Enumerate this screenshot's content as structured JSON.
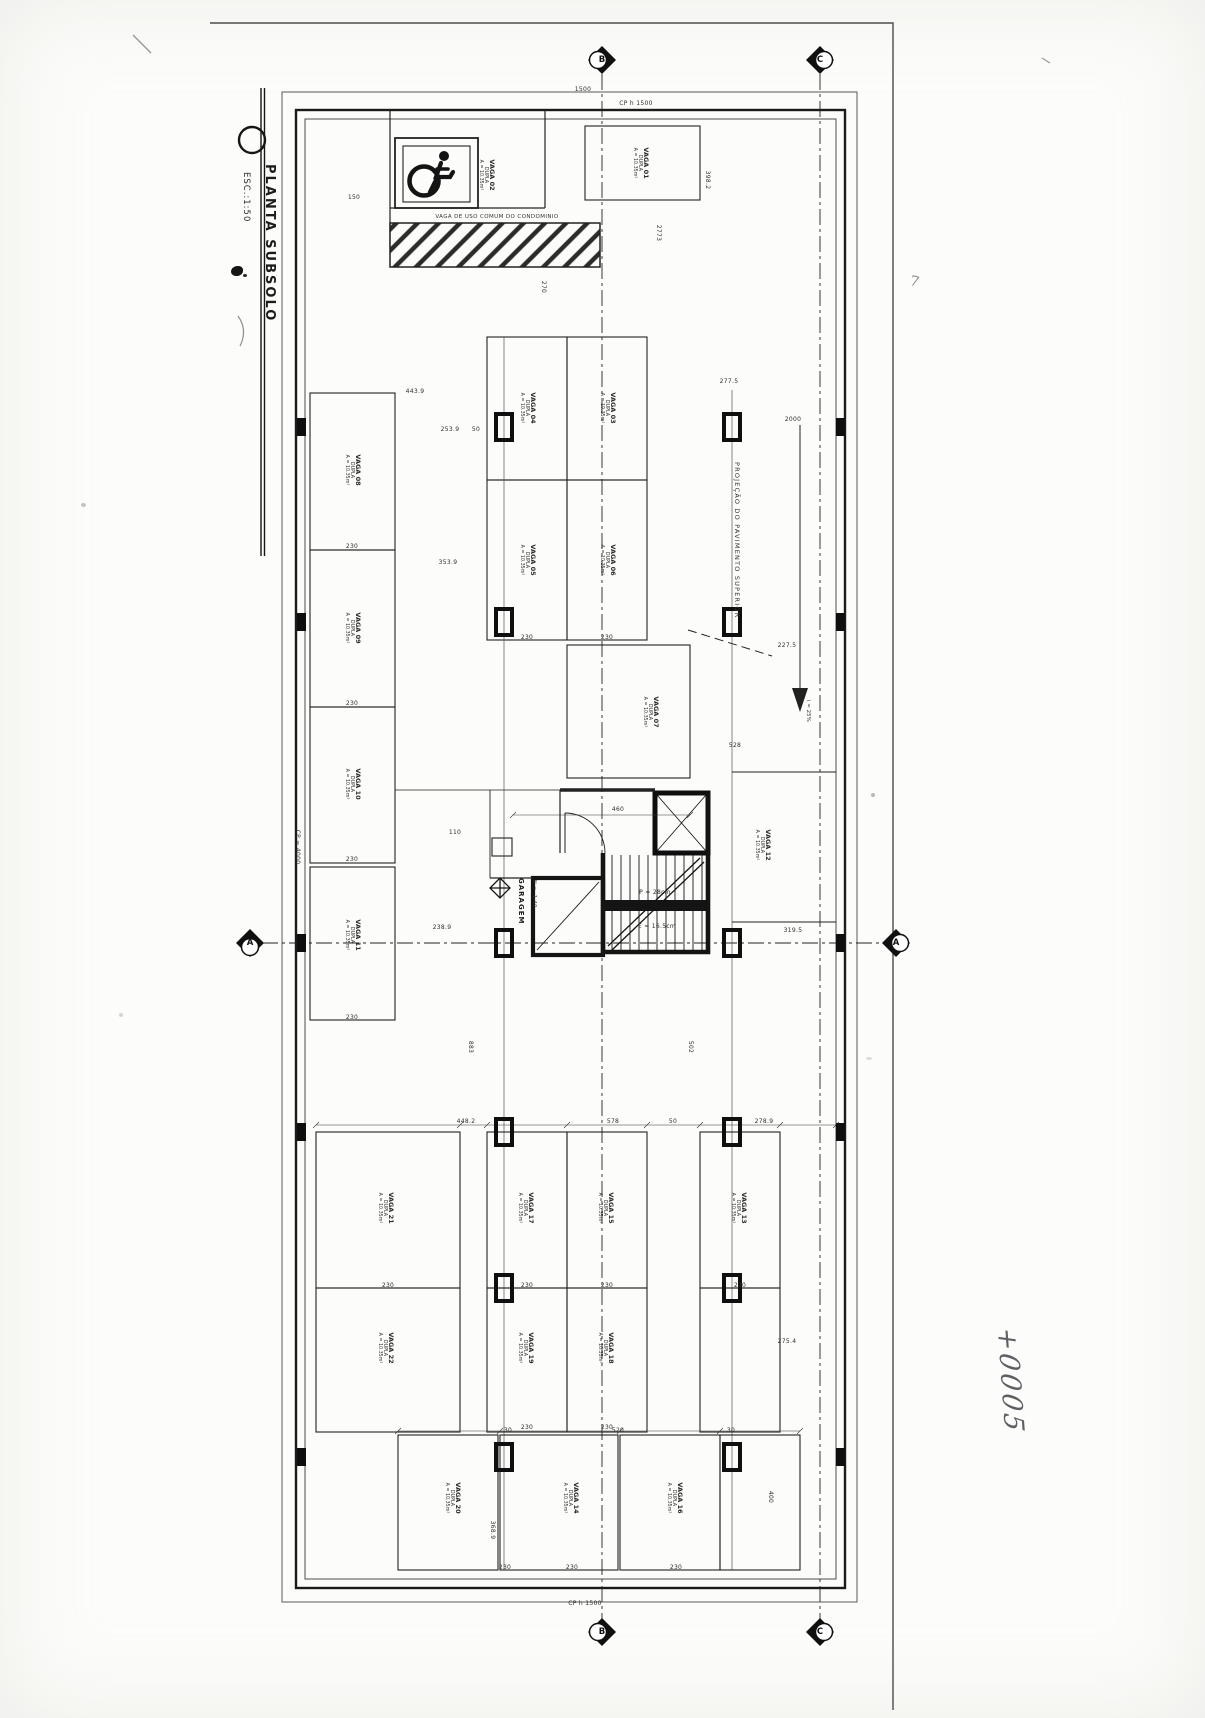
{
  "title_block": {
    "title": "PLANTA SUBSOLO",
    "scale": "ESC.:1:50"
  },
  "labels": {
    "common_stall": "VAGA DE USO COMUM DO CONDOMINIO",
    "garage": "GARAGEM",
    "garage_level": "N = -1.40",
    "ramp_projection": "PROJEÇÃO DO PAVIMENTO SUPERIOR",
    "ramp_slope": "i = 25%",
    "handwritten_note": "+0005",
    "pencil_mark": "7"
  },
  "markers": [
    {
      "t": "B",
      "x": 602,
      "y": 60
    },
    {
      "t": "C",
      "x": 820,
      "y": 60
    },
    {
      "t": "A",
      "x": 250,
      "y": 943
    },
    {
      "t": "A",
      "x": 896,
      "y": 943
    },
    {
      "t": "B",
      "x": 602,
      "y": 1632
    },
    {
      "t": "C",
      "x": 820,
      "y": 1632
    }
  ],
  "stalls": [
    {
      "l1": "VAGA 01",
      "l2": "DUPLA",
      "l3": "A = 10.35m²",
      "x": 640,
      "y": 163,
      "r": 90
    },
    {
      "l1": "VAGA 02",
      "l2": "DUPLA",
      "l3": "A = 10.35m²",
      "x": 486,
      "y": 175,
      "r": 90
    },
    {
      "l1": "VAGA 03",
      "l2": "DUPLA",
      "l3": "A = 10.35m²",
      "x": 607,
      "y": 408,
      "r": 90
    },
    {
      "l1": "VAGA 04",
      "l2": "DUPLA",
      "l3": "A = 10.35m²",
      "x": 527,
      "y": 408,
      "r": 90
    },
    {
      "l1": "VAGA 05",
      "l2": "DUPLA",
      "l3": "A = 10.35m²",
      "x": 527,
      "y": 560,
      "r": 90
    },
    {
      "l1": "VAGA 06",
      "l2": "DUPLA",
      "l3": "A = 10.35m²",
      "x": 607,
      "y": 560,
      "r": 90
    },
    {
      "l1": "VAGA 07",
      "l2": "DUPLA",
      "l3": "A = 10.35m²",
      "x": 650,
      "y": 712,
      "r": 90
    },
    {
      "l1": "VAGA 08",
      "l2": "DUPLA",
      "l3": "A = 10.35m²",
      "x": 352,
      "y": 470,
      "r": 90
    },
    {
      "l1": "VAGA 09",
      "l2": "DUPLA",
      "l3": "A = 10.35m²",
      "x": 352,
      "y": 628,
      "r": 90
    },
    {
      "l1": "VAGA 10",
      "l2": "DUPLA",
      "l3": "A = 10.35m²",
      "x": 352,
      "y": 784,
      "r": 90
    },
    {
      "l1": "VAGA 11",
      "l2": "DUPLA",
      "l3": "A = 10.35m²",
      "x": 352,
      "y": 935,
      "r": 90
    },
    {
      "l1": "VAGA 12",
      "l2": "DUPLA",
      "l3": "A = 10.35m²",
      "x": 762,
      "y": 845,
      "r": 90
    },
    {
      "l1": "VAGA 13",
      "l2": "DUPLA",
      "l3": "A = 10.35m²",
      "x": 738,
      "y": 1208,
      "r": 90
    },
    {
      "l1": "VAGA 14",
      "l2": "DUPLA",
      "l3": "A = 10.35m²",
      "x": 570,
      "y": 1498,
      "r": 90
    },
    {
      "l1": "VAGA 15",
      "l2": "DUPLA",
      "l3": "A = 10.35m²",
      "x": 605,
      "y": 1208,
      "r": 90
    },
    {
      "l1": "VAGA 16",
      "l2": "DUPLA",
      "l3": "A = 10.35m²",
      "x": 674,
      "y": 1498,
      "r": 90
    },
    {
      "l1": "VAGA 17",
      "l2": "DUPLA",
      "l3": "A = 10.35m²",
      "x": 525,
      "y": 1208,
      "r": 90
    },
    {
      "l1": "VAGA 18",
      "l2": "DUPLA",
      "l3": "A = 10.35m²",
      "x": 605,
      "y": 1348,
      "r": 90
    },
    {
      "l1": "VAGA 19",
      "l2": "DUPLA",
      "l3": "A = 10.35m²",
      "x": 525,
      "y": 1348,
      "r": 90
    },
    {
      "l1": "VAGA 20",
      "l2": "DUPLA",
      "l3": "A = 10.35m²",
      "x": 452,
      "y": 1498,
      "r": 90
    },
    {
      "l1": "VAGA 21",
      "l2": "DUPLA",
      "l3": "A = 10.35m²",
      "x": 385,
      "y": 1208,
      "r": 90
    },
    {
      "l1": "VAGA 22",
      "l2": "DUPLA",
      "l3": "A = 10.35m²",
      "x": 385,
      "y": 1348,
      "r": 90
    }
  ],
  "annotations": [
    {
      "t": "1500",
      "x": 583,
      "y": 90
    },
    {
      "t": "CP h 1500",
      "x": 636,
      "y": 104
    },
    {
      "t": "150",
      "x": 354,
      "y": 198
    },
    {
      "t": "398.2",
      "x": 707,
      "y": 180,
      "r": 90
    },
    {
      "t": "2773",
      "x": 658,
      "y": 233,
      "r": 90
    },
    {
      "t": "270",
      "x": 543,
      "y": 287,
      "r": 90
    },
    {
      "t": "277.5",
      "x": 729,
      "y": 382
    },
    {
      "t": "2000",
      "x": 793,
      "y": 420
    },
    {
      "t": "443.9",
      "x": 415,
      "y": 392
    },
    {
      "t": "253.9",
      "x": 450,
      "y": 430
    },
    {
      "t": "50",
      "x": 476,
      "y": 430
    },
    {
      "t": "353.9",
      "x": 448,
      "y": 563
    },
    {
      "t": "238.9",
      "x": 442,
      "y": 928
    },
    {
      "t": "319.5",
      "x": 793,
      "y": 931
    },
    {
      "t": "227.5",
      "x": 787,
      "y": 646
    },
    {
      "t": "528",
      "x": 735,
      "y": 746
    },
    {
      "t": "460",
      "x": 618,
      "y": 810
    },
    {
      "t": "110",
      "x": 455,
      "y": 833
    },
    {
      "t": "P = 28cm",
      "x": 655,
      "y": 893
    },
    {
      "t": "E = 16.5cm",
      "x": 657,
      "y": 927
    },
    {
      "t": "CP = 4000",
      "x": 297,
      "y": 847,
      "r": 90
    },
    {
      "t": "883",
      "x": 470,
      "y": 1047,
      "r": 90
    },
    {
      "t": "502",
      "x": 690,
      "y": 1047,
      "r": 90
    },
    {
      "t": "448.2",
      "x": 466,
      "y": 1122
    },
    {
      "t": "578",
      "x": 613,
      "y": 1122
    },
    {
      "t": "50",
      "x": 673,
      "y": 1122
    },
    {
      "t": "278.9",
      "x": 764,
      "y": 1122
    },
    {
      "t": "520",
      "x": 618,
      "y": 1431
    },
    {
      "t": "30",
      "x": 508,
      "y": 1431
    },
    {
      "t": "30",
      "x": 731,
      "y": 1431
    },
    {
      "t": "400",
      "x": 770,
      "y": 1497,
      "r": 90
    },
    {
      "t": "275.4",
      "x": 787,
      "y": 1342
    },
    {
      "t": "368.9",
      "x": 492,
      "y": 1530,
      "r": 90
    },
    {
      "t": "230",
      "x": 352,
      "y": 547
    },
    {
      "t": "230",
      "x": 352,
      "y": 704
    },
    {
      "t": "230",
      "x": 352,
      "y": 860
    },
    {
      "t": "230",
      "x": 352,
      "y": 1018
    },
    {
      "t": "230",
      "x": 527,
      "y": 638
    },
    {
      "t": "230",
      "x": 607,
      "y": 638
    },
    {
      "t": "230",
      "x": 388,
      "y": 1286
    },
    {
      "t": "230",
      "x": 527,
      "y": 1286
    },
    {
      "t": "230",
      "x": 607,
      "y": 1286
    },
    {
      "t": "230",
      "x": 740,
      "y": 1286
    },
    {
      "t": "230",
      "x": 527,
      "y": 1428
    },
    {
      "t": "230",
      "x": 607,
      "y": 1428
    },
    {
      "t": "230",
      "x": 505,
      "y": 1568
    },
    {
      "t": "230",
      "x": 572,
      "y": 1568
    },
    {
      "t": "230",
      "x": 676,
      "y": 1568
    },
    {
      "t": "CP h 1500",
      "x": 585,
      "y": 1604
    }
  ]
}
